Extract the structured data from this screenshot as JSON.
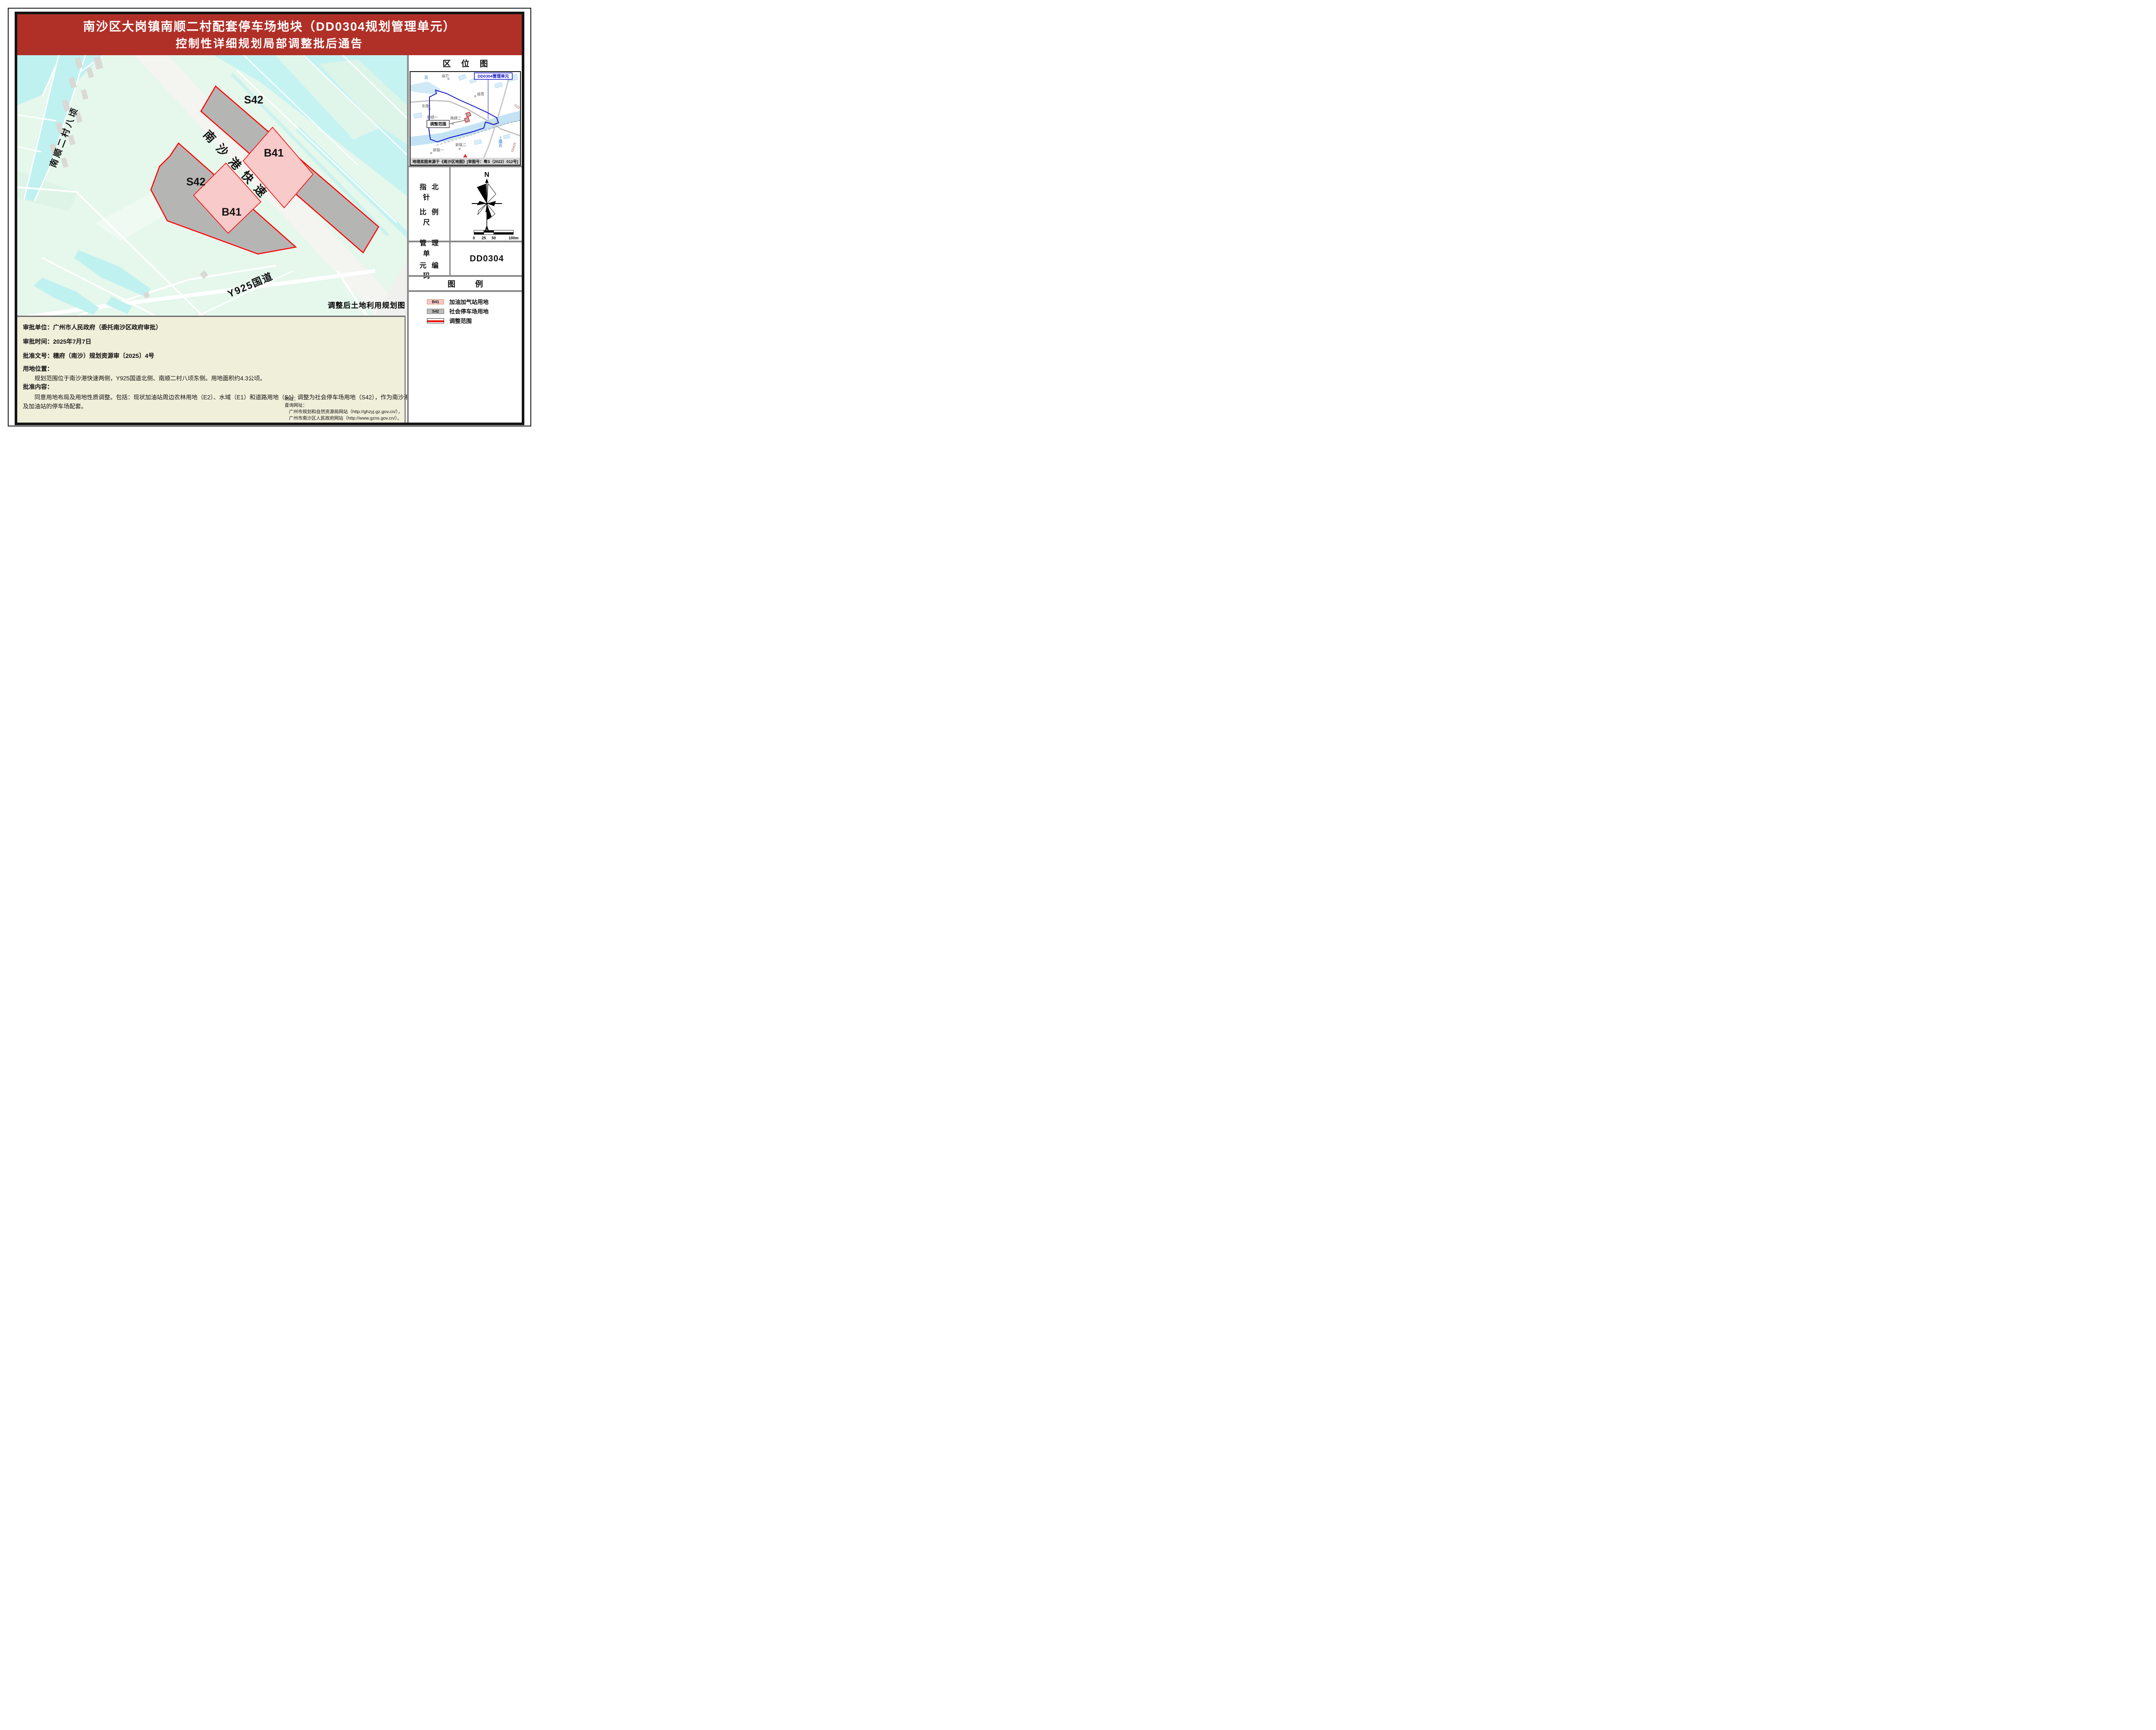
{
  "header": {
    "title_line1": "南沙区大岗镇南顺二村配套停车场地块（DD0304规划管理单元）",
    "title_line2": "控制性详细规划局部调整批后通告"
  },
  "map": {
    "caption": "调整后土地利用规划图",
    "labels": {
      "s42": "S42",
      "b41": "B41",
      "expressway": "南沙港快速",
      "road_y925": "Y925国道",
      "canal": "南顺二村八顷"
    }
  },
  "location_map": {
    "title": "区位图",
    "unit_box": "DD0304管理单元",
    "range_box": "调整范围",
    "caption": "地理底图来源于《南沙区地图》[审图号：粤S（2022）012号]",
    "places": {
      "li": "沥",
      "miaobei": "庙贝",
      "miaoqing": "庙青",
      "donglong": "东隆",
      "nanshun1": "南顺一",
      "nanshun2": "南顺二",
      "xinlian2": "新联二",
      "xinlian1": "新联一",
      "shanghengli": "上横沥",
      "g0425": "G0425",
      "g22": "G22"
    }
  },
  "compass": {
    "section_line1": "指北针",
    "section_line2": "比例尺",
    "north": "N",
    "scale_ticks": [
      "0",
      "25",
      "50",
      "100m"
    ]
  },
  "unit_code": {
    "label_line1": "管理单",
    "label_line2": "元编码",
    "value": "DD0304"
  },
  "legend": {
    "title": "图例",
    "items": [
      {
        "code": "B41",
        "label": "加油加气站用地",
        "color": "#f6c5c5"
      },
      {
        "code": "S42",
        "label": "社会停车场用地",
        "color": "#bcbcbc"
      },
      {
        "code": "",
        "label": "调整范围",
        "color": "#ee0000"
      }
    ]
  },
  "info": {
    "approver": "审批单位：广州市人民政府（委托南沙区政府审批）",
    "date": "审批时间：2025年7月7日",
    "doc_no": "批准文号：穗府（南沙）规划资源审〔2025〕4号",
    "location_title": "用地位置：",
    "location_body": "规划范围位于南沙港快速两侧，Y925国道北侧、南顺二村八顷东侧。用地面积约4.3公顷。",
    "content_title": "批准内容：",
    "content_line1": "同意用地布局及用地性质调整。包括：现状加油站周边农林用地（E2）、水域（E1）和道路用地（S1）调整为社会停车场用地（S42），作为南沙港快速路",
    "content_line2": "及加油站的停车场配套。",
    "notes_title": "附注：",
    "notes_query": "查询网址：",
    "notes_site1": "广州市规划和自然资源局网站（http://ghzyj.gz.gov.cn/），",
    "notes_site2": "广州市南沙区人民政府网站（http://www.gzns.gov.cn/）。"
  },
  "colors": {
    "header_red": "#b03028",
    "panel_beige": "#f0efda",
    "s42_gray": "#b5b5b3",
    "b41_pink": "#f9caca",
    "boundary_red": "#ff0000",
    "water_cyan": "#c5f3f2",
    "field_green": "#e6f7ec",
    "expressway_gray": "#f4f4f1",
    "loc_boundary_blue": "#1414c8"
  }
}
